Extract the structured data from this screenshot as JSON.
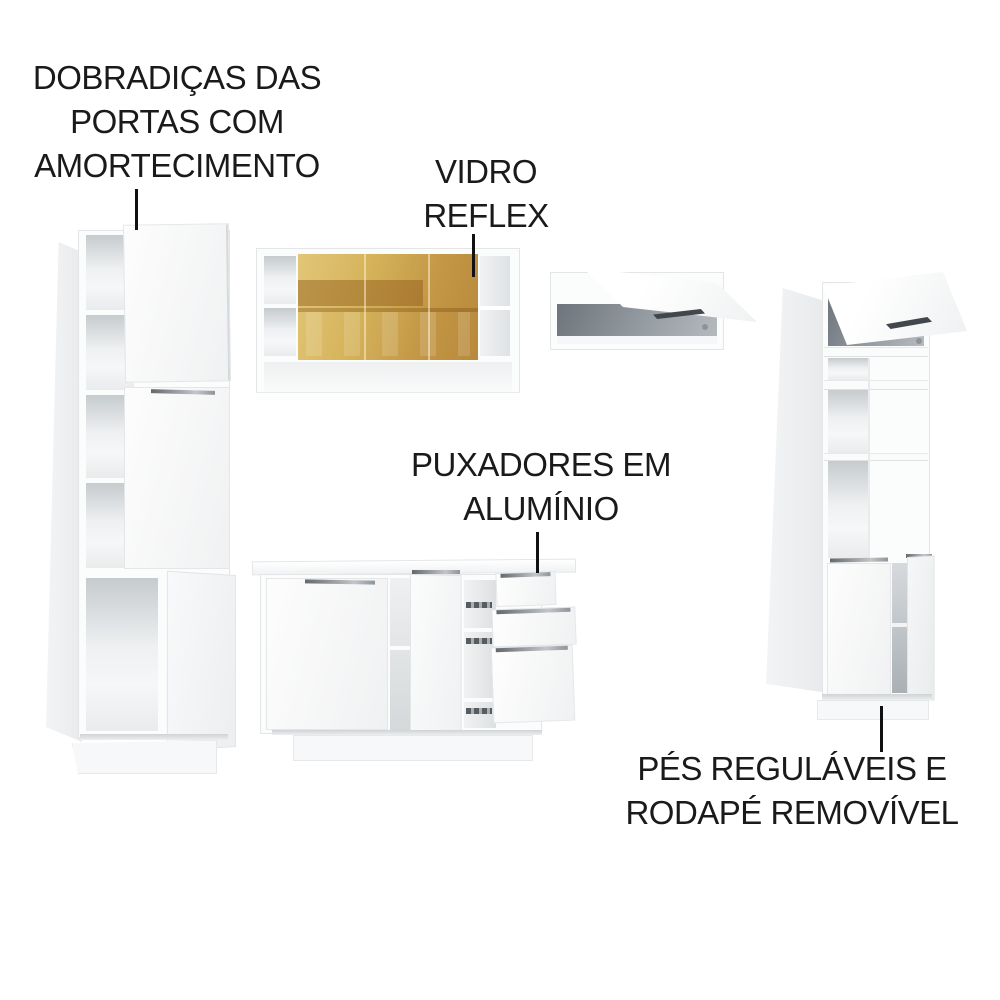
{
  "callouts": {
    "hinges": {
      "label": "DOBRADIÇAS DAS\nPORTAS COM\nAMORTECIMENTO"
    },
    "glass": {
      "label": "VIDRO\nREFLEX"
    },
    "handles": {
      "label": "PUXADORES EM\nALUMÍNIO"
    },
    "feet": {
      "label": "PÉS REGULÁVEIS E\nRODAPÉ REMOVÍVEL"
    }
  },
  "colors": {
    "background": "#ffffff",
    "text": "#1a1a1a",
    "pointer_line": "#111111",
    "cabinet_white": "#fbfcfc",
    "cabinet_edge": "#e3e5e7",
    "cabinet_side": "#edeff0",
    "interior_gray": "#c9cdd0",
    "interior_dark": "#6e757c",
    "glass_amber_light": "#e2c678",
    "glass_amber_dark": "#b8893c",
    "handle_dark": "#41474d",
    "handle_aluminum": "#b7bbbe"
  }
}
